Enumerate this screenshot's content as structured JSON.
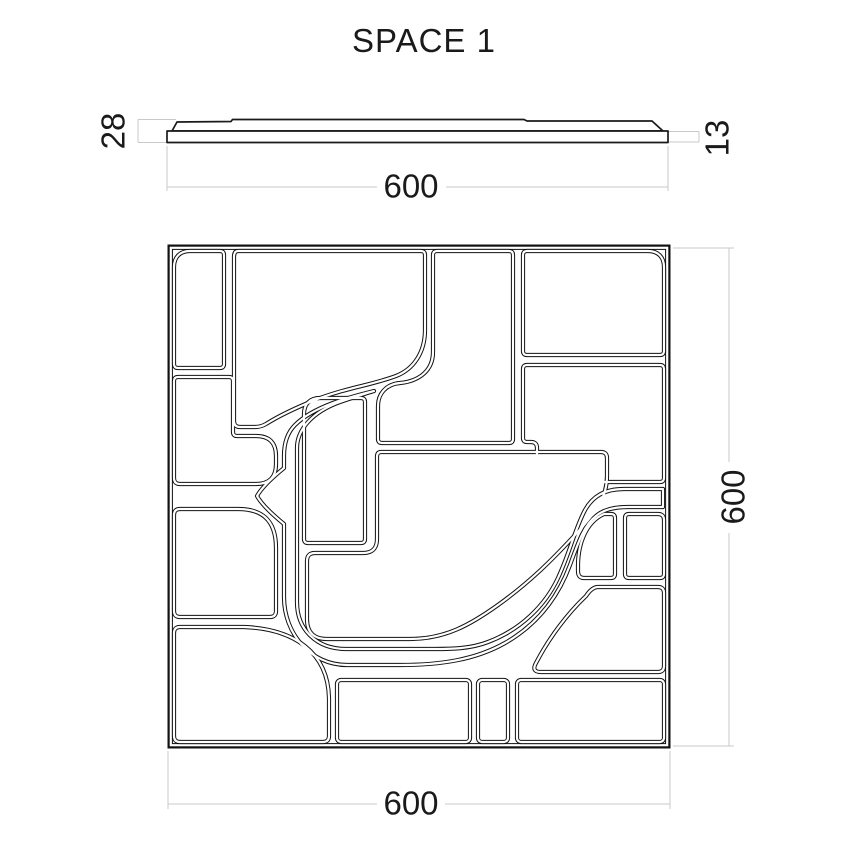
{
  "title": "SPACE 1",
  "profile_view": {
    "thickness_total": "28",
    "thickness_base": "13",
    "width": "600"
  },
  "front_view": {
    "width": "600",
    "height": "600"
  },
  "colors": {
    "line": "#1a1a1a",
    "dim_line": "#c9c9c9",
    "background": "#ffffff"
  }
}
